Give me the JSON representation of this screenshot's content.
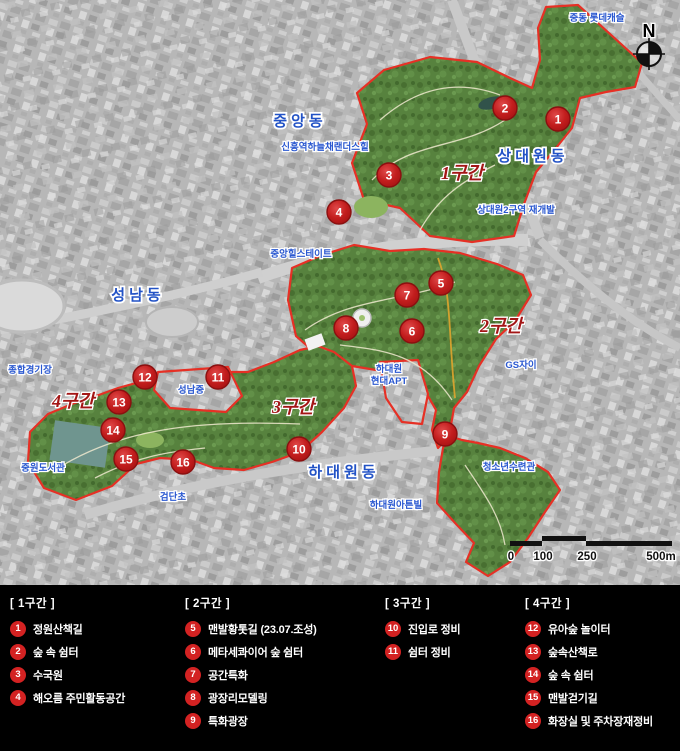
{
  "map": {
    "compass": {
      "label": "N"
    },
    "district_labels": [
      {
        "label": "중앙동",
        "x": 300,
        "y": 126
      },
      {
        "label": "상대원동",
        "x": 533,
        "y": 161
      },
      {
        "label": "성남동",
        "x": 138,
        "y": 300
      },
      {
        "label": "하대원동",
        "x": 344,
        "y": 477
      }
    ],
    "facility_labels": [
      {
        "label": "중동 롯데캐슬",
        "x": 597,
        "y": 21
      },
      {
        "label": "신흥역하늘채랜더스힐",
        "x": 325,
        "y": 150
      },
      {
        "label": "상대원2구역 재개발",
        "x": 516,
        "y": 213
      },
      {
        "label": "중앙힐스테이트",
        "x": 301,
        "y": 257
      },
      {
        "label": "GS자이",
        "x": 521,
        "y": 368
      },
      {
        "label": "종합경기장",
        "x": 30,
        "y": 373
      },
      {
        "label": "성남중",
        "x": 191,
        "y": 393
      },
      {
        "label": "하대원",
        "x": 389,
        "y": 372
      },
      {
        "label": "현대APT",
        "x": 389,
        "y": 384
      },
      {
        "label": "중원도서관",
        "x": 43,
        "y": 471
      },
      {
        "label": "검단초",
        "x": 173,
        "y": 500
      },
      {
        "label": "하대원아튼빌",
        "x": 396,
        "y": 508
      },
      {
        "label": "청소년수련관",
        "x": 509,
        "y": 470
      }
    ],
    "section_labels": [
      {
        "label": "1구간",
        "x": 462,
        "y": 179
      },
      {
        "label": "2구간",
        "x": 501,
        "y": 332
      },
      {
        "label": "3구간",
        "x": 293,
        "y": 413
      },
      {
        "label": "4구간",
        "x": 73,
        "y": 407
      }
    ],
    "markers": [
      {
        "n": "1",
        "x": 558,
        "y": 119
      },
      {
        "n": "2",
        "x": 505,
        "y": 108
      },
      {
        "n": "3",
        "x": 389,
        "y": 175
      },
      {
        "n": "4",
        "x": 339,
        "y": 212
      },
      {
        "n": "5",
        "x": 441,
        "y": 283
      },
      {
        "n": "6",
        "x": 412,
        "y": 331
      },
      {
        "n": "7",
        "x": 407,
        "y": 295
      },
      {
        "n": "8",
        "x": 346,
        "y": 328
      },
      {
        "n": "9",
        "x": 445,
        "y": 434
      },
      {
        "n": "10",
        "x": 299,
        "y": 449
      },
      {
        "n": "11",
        "x": 218,
        "y": 377
      },
      {
        "n": "12",
        "x": 145,
        "y": 377
      },
      {
        "n": "13",
        "x": 119,
        "y": 402
      },
      {
        "n": "14",
        "x": 113,
        "y": 430
      },
      {
        "n": "15",
        "x": 126,
        "y": 459
      },
      {
        "n": "16",
        "x": 183,
        "y": 462
      }
    ],
    "scalebar": {
      "labels": [
        {
          "text": "0",
          "x": 511
        },
        {
          "text": "100",
          "x": 543
        },
        {
          "text": "250",
          "x": 587
        },
        {
          "text": "500m",
          "x": 661
        }
      ]
    }
  },
  "legend": {
    "sections": [
      {
        "title": "[ 1구간 ]",
        "x": 10,
        "items": [
          {
            "n": "1",
            "label": "정원산책길"
          },
          {
            "n": "2",
            "label": "숲 속 쉼터"
          },
          {
            "n": "3",
            "label": "수국원"
          },
          {
            "n": "4",
            "label": "해오름 주민활동공간"
          }
        ]
      },
      {
        "title": "[ 2구간 ]",
        "x": 185,
        "items": [
          {
            "n": "5",
            "label": "맨발황톳길 (23.07.조성)"
          },
          {
            "n": "6",
            "label": "메타세콰이어 숲 쉼터"
          },
          {
            "n": "7",
            "label": "공간특화"
          },
          {
            "n": "8",
            "label": "광장리모델링"
          },
          {
            "n": "9",
            "label": "특화광장"
          }
        ]
      },
      {
        "title": "[ 3구간 ]",
        "x": 385,
        "items": [
          {
            "n": "10",
            "label": "진입로 정비"
          },
          {
            "n": "11",
            "label": "쉼터 정비"
          }
        ]
      },
      {
        "title": "[ 4구간 ]",
        "x": 525,
        "items": [
          {
            "n": "12",
            "label": "유아숲 놀이터"
          },
          {
            "n": "13",
            "label": "숲속산책로"
          },
          {
            "n": "14",
            "label": "숲 속 쉼터"
          },
          {
            "n": "15",
            "label": "맨발걷기길"
          },
          {
            "n": "16",
            "label": "화장실 및 주차장재정비"
          }
        ]
      }
    ]
  },
  "colors": {
    "marker_red": "#c21d1d",
    "legend_badge_red": "#d32222",
    "boundary_red": "#e63025",
    "park_green": "#57823e",
    "label_blue": "#2a58d0",
    "section_label_red": "#a31616",
    "legend_bg": "#000000"
  }
}
